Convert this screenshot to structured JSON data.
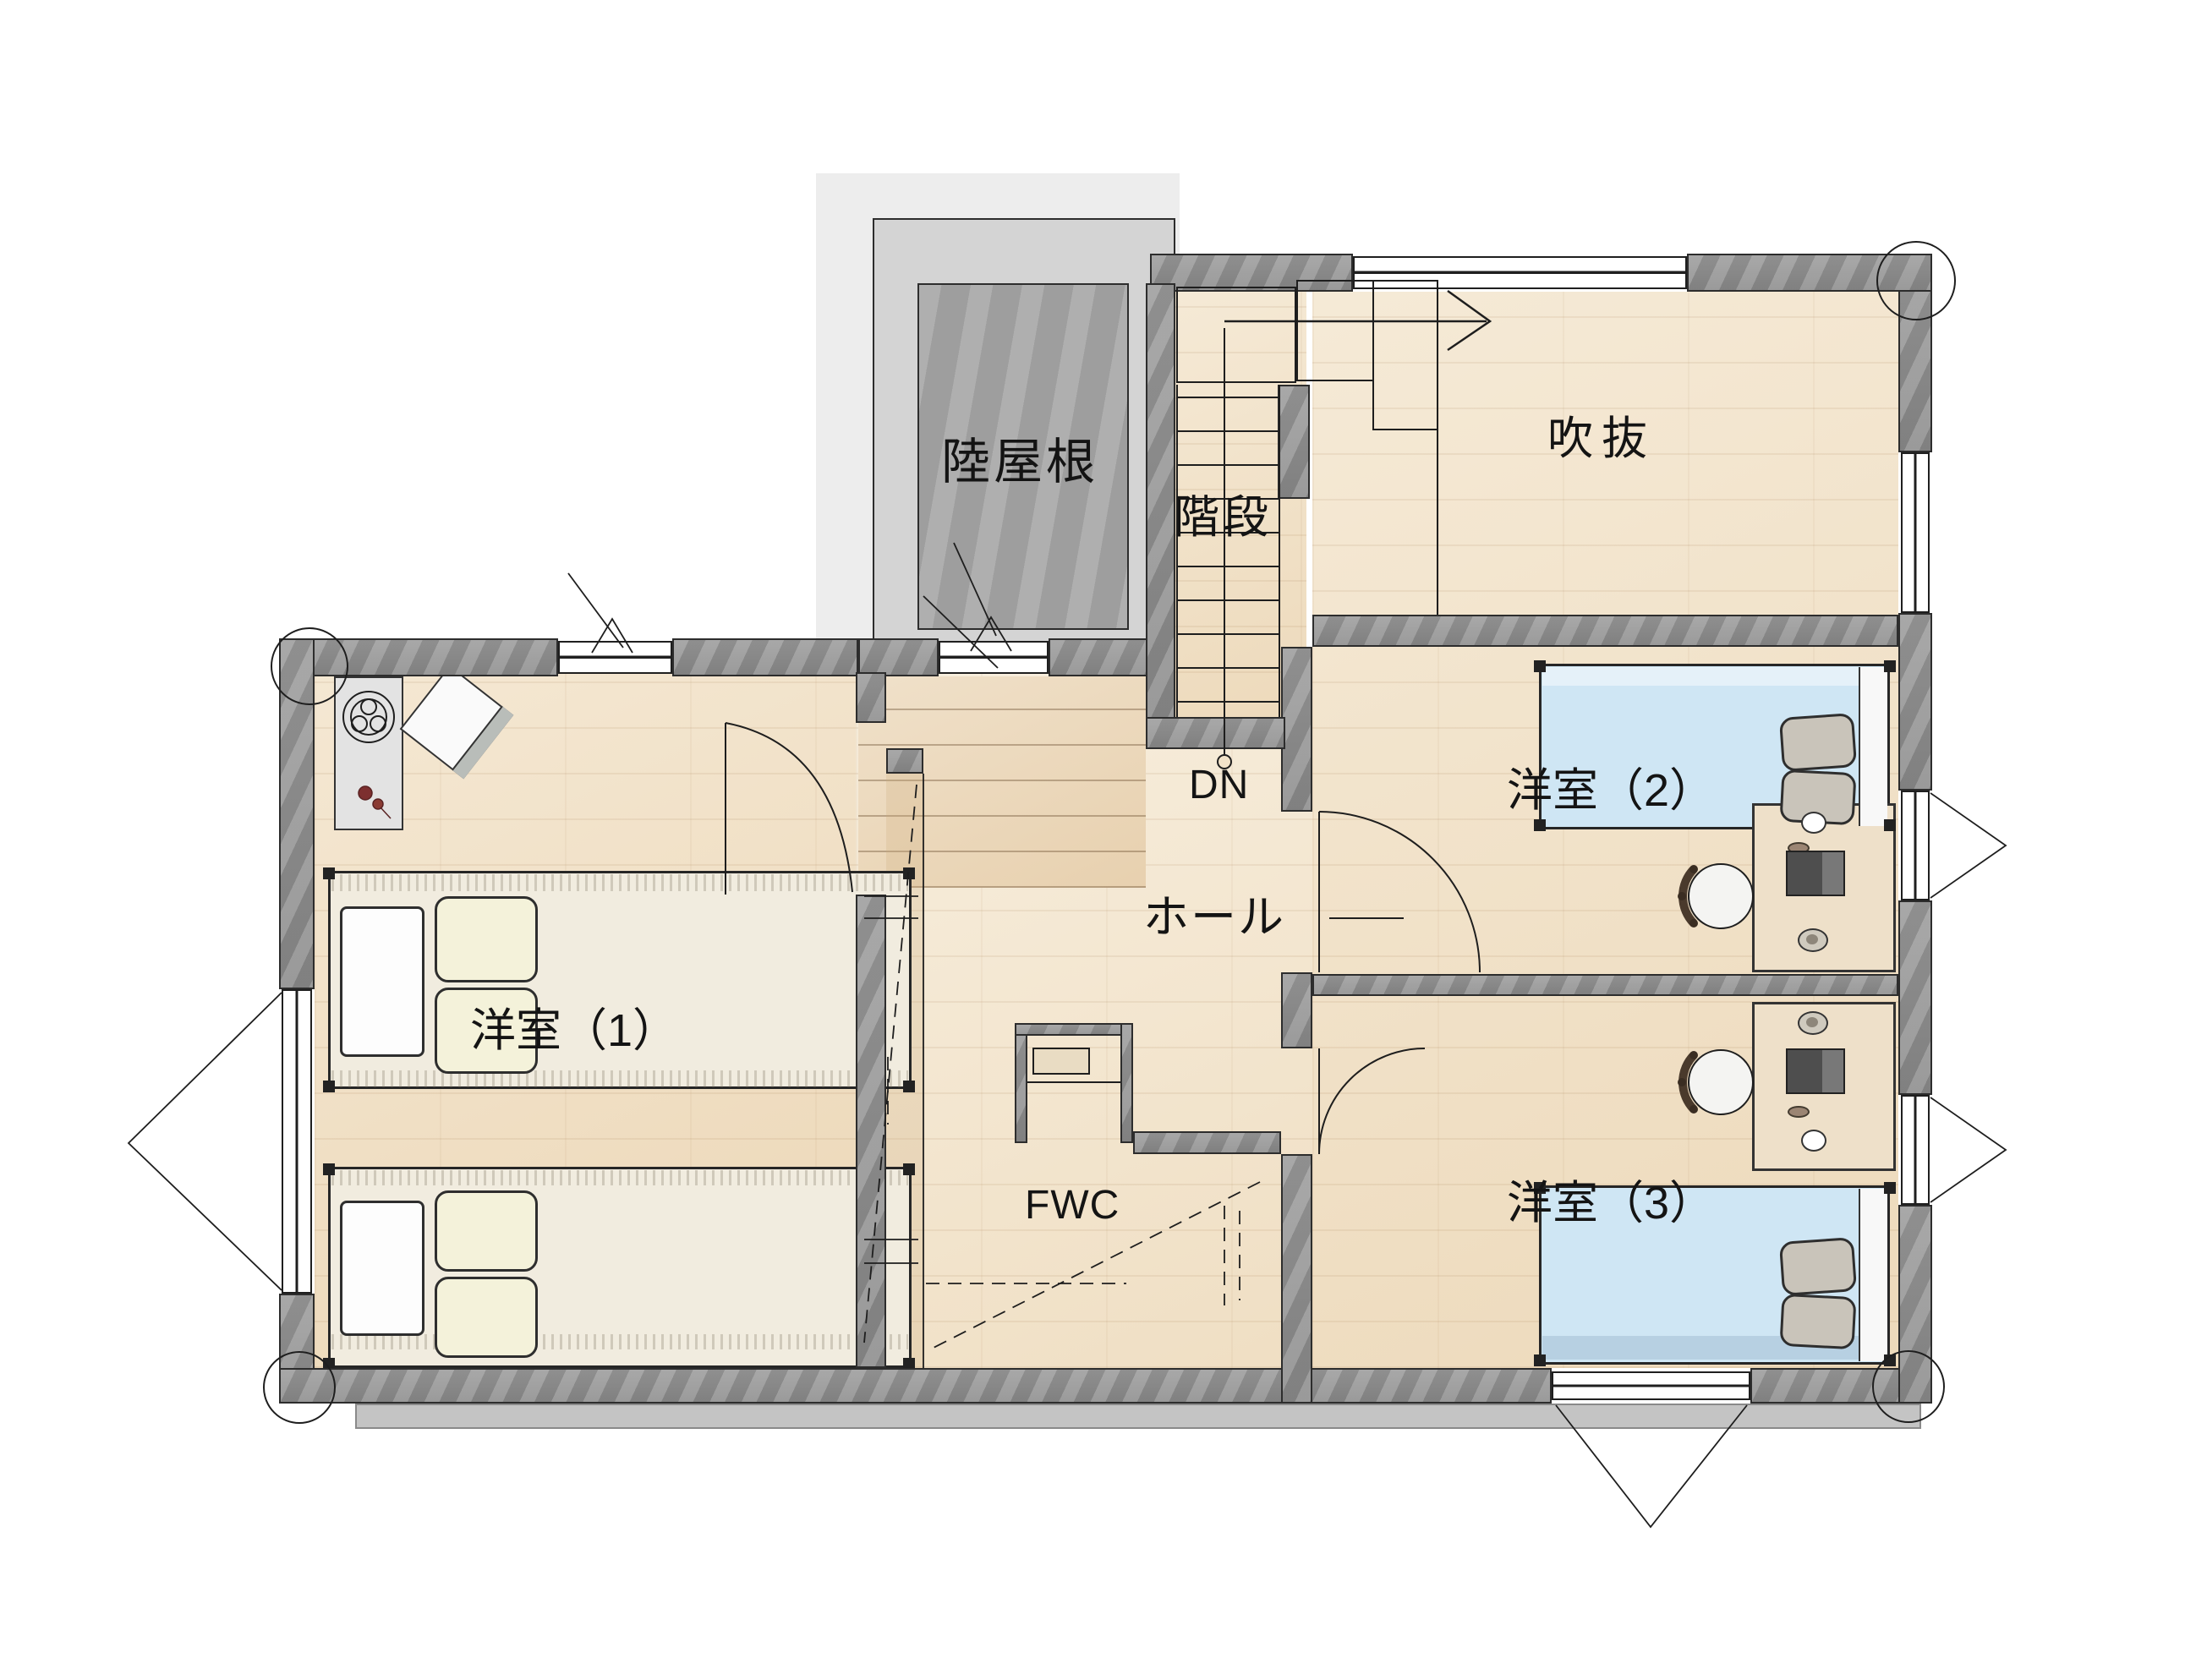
{
  "plan": {
    "rooms": {
      "flat_roof": {
        "label": "陸屋根"
      },
      "stairs": {
        "label": "階段",
        "direction_label": "DN"
      },
      "void_atrium": {
        "label": "吹抜"
      },
      "hall": {
        "label": "ホール"
      },
      "bedroom1": {
        "label": "洋室（1）"
      },
      "bedroom2": {
        "label": "洋室（2）"
      },
      "bedroom3": {
        "label": "洋室（3）"
      },
      "family_closet": {
        "label": "FWC"
      }
    },
    "colors": {
      "wall": "#8f8f8f",
      "floor": "#f2e3c9",
      "deck_floor": "#ecd9bc",
      "roof_outer": "#d4d4d4",
      "roof_inner": "#a6a6a6",
      "bed_blue": "#cfe6f4",
      "mattress_cream": "#f1ecdf",
      "pillow_gray": "#c9c4ba",
      "pillow_cream": "#f4f2da",
      "line": "#1e1e1e"
    }
  }
}
